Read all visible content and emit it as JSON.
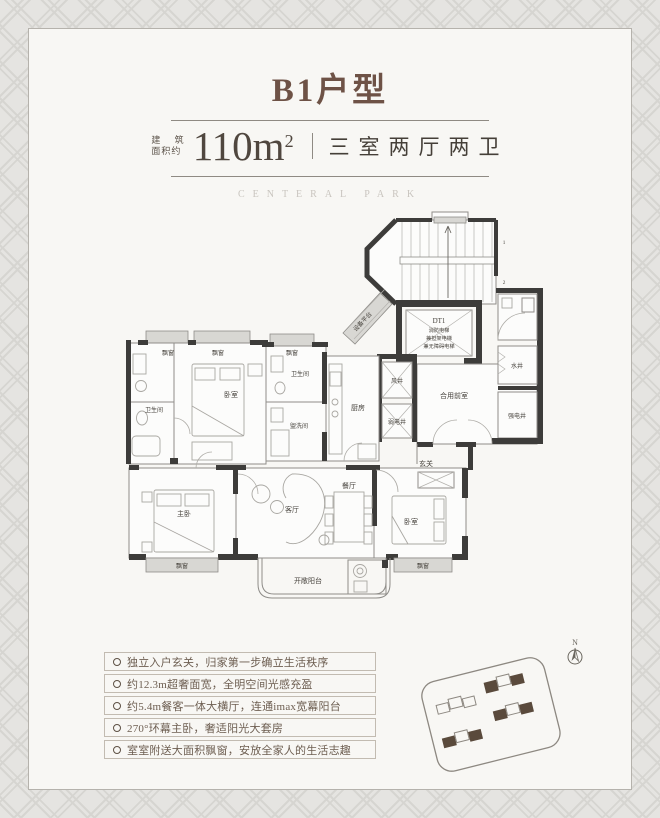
{
  "header": {
    "title": "B1户型",
    "area_prefix_line1": "建 筑",
    "area_prefix_line2": "面积约",
    "area_value": "110m",
    "area_exponent": "2",
    "layout_type": "三室两厅两卫",
    "watermark": "CENTERAL PARK"
  },
  "floorplan": {
    "rooms": {
      "bay_window": "飘窗",
      "bedroom": "卧室",
      "master_bedroom": "主卧",
      "living_room": "客厅",
      "dining_room": "餐厅",
      "kitchen": "厨房",
      "bathroom": "卫生间",
      "washroom": "盥洗间",
      "foyer": "玄关",
      "shared_vestibule": "合用前室",
      "air_shaft": "风井",
      "weak_current_shaft": "弱电井",
      "water_shaft": "水井",
      "strong_current_shaft": "强电井",
      "equipment_platform": "设备平台",
      "open_balcony": "开敞阳台"
    },
    "elevator": {
      "id": "DT1",
      "line1": "消防电梯",
      "line2": "兼担架电梯",
      "line3": "兼无障碍电梯"
    },
    "stair_marks": {
      "upper": "1",
      "lower": "2"
    }
  },
  "features": {
    "items": [
      "独立入户玄关，归家第一步确立生活秩序",
      "约12.3m超奢面宽，全明空间光感充盈",
      "约5.4m餐客一体大横厅，连通imax宽幕阳台",
      "270°环幕主卧，奢适阳光大套房",
      "室室附送大面积飘窗，安放全家人的生活志趣"
    ]
  },
  "sitemap": {
    "north_label": "N"
  },
  "colors": {
    "title": "#6e5246",
    "text_dark": "#50473f",
    "feature_text": "#6d5e51",
    "wall_dark": "#3d3c3a",
    "building_fill": "#5a4a3c",
    "card_bg": "#f8f7f4"
  }
}
